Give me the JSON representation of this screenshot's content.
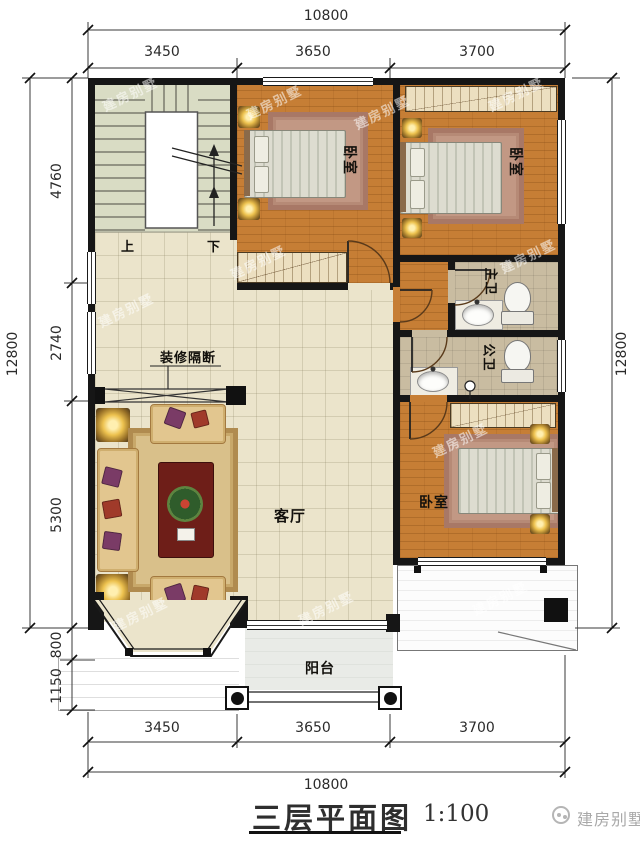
{
  "meta": {
    "title": "三层平面图",
    "scale": "1:100",
    "logo": "建房别墅",
    "watermark": "建房别墅"
  },
  "dims": {
    "top": {
      "total": "10800",
      "segments": [
        "3450",
        "3650",
        "3700"
      ]
    },
    "bottom": {
      "total": "10800",
      "segments": [
        "3450",
        "3650",
        "3700"
      ]
    },
    "left": {
      "total": "12800",
      "segments": [
        "4760",
        "2740",
        "5300",
        "800",
        "1150"
      ]
    },
    "right": {
      "total": "12800"
    }
  },
  "rooms": {
    "bedroom_top_mid": {
      "label": "卧室"
    },
    "bedroom_top_right": {
      "label": "卧室"
    },
    "bedroom_bottom_right": {
      "label": "卧室"
    },
    "living": {
      "label": "客厅"
    },
    "bath_master": {
      "label": "主卫"
    },
    "bath_public": {
      "label": "公卫"
    },
    "balcony": {
      "label": "阳台"
    },
    "partition": {
      "label": "装修隔断"
    },
    "stairs": {
      "up": "上",
      "down": "下"
    }
  },
  "colors": {
    "wall": "#161616",
    "wood_floor": "#c67e35",
    "living_floor": "#ebe4cb",
    "stair_floor": "#d9dcc4",
    "bath_floor": "#c9bca1",
    "rug": "#c29884",
    "dim_text": "#2b2b2b"
  }
}
